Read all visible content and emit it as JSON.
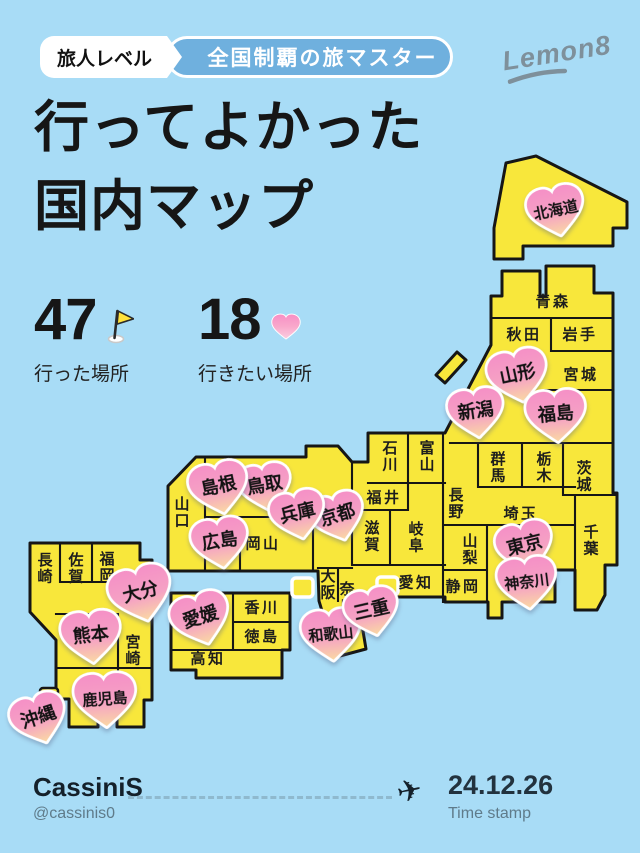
{
  "badge": {
    "level_label": "旅人レベル",
    "level_title": "全国制覇の旅マスター"
  },
  "logo_text": "Lemon8",
  "title": {
    "line1": "行ってよかった",
    "line2": "国内マップ"
  },
  "stats": {
    "visited": {
      "value": "47",
      "label": "行った場所",
      "icon": "flag-icon"
    },
    "wishlist": {
      "value": "18",
      "label": "行きたい場所",
      "icon": "heart-icon"
    }
  },
  "footer": {
    "username": "CassiniS",
    "handle": "@cassinis0",
    "plane_icon": "✈",
    "date": "24.12.26",
    "date_label": "Time stamp"
  },
  "colors": {
    "background": "#A8DCF6",
    "land_yellow": "#F8E73B",
    "outline": "#161616",
    "heart_pink_top": "#F590C6",
    "heart_peach_bottom": "#FAD7A4",
    "badge_blue": "#6FB0DE",
    "logo_gray": "#7E909B",
    "muted_text": "#5F7B8A"
  },
  "map": {
    "labels": [
      {
        "text": "青森",
        "x": 553,
        "y": 301,
        "o": "h"
      },
      {
        "text": "秋田",
        "x": 524,
        "y": 334,
        "o": "h"
      },
      {
        "text": "岩手",
        "x": 580,
        "y": 334,
        "o": "h"
      },
      {
        "text": "宮城",
        "x": 581,
        "y": 374,
        "o": "h"
      },
      {
        "text": "群馬",
        "x": 498,
        "y": 467,
        "o": "v"
      },
      {
        "text": "栃木",
        "x": 544,
        "y": 467,
        "o": "v"
      },
      {
        "text": "茨城",
        "x": 584,
        "y": 476,
        "o": "v"
      },
      {
        "text": "埼玉",
        "x": 521,
        "y": 513,
        "o": "h"
      },
      {
        "text": "千葉",
        "x": 591,
        "y": 540,
        "o": "v"
      },
      {
        "text": "山梨",
        "x": 470,
        "y": 549,
        "o": "v"
      },
      {
        "text": "長野",
        "x": 456,
        "y": 503,
        "o": "v"
      },
      {
        "text": "静岡",
        "x": 463,
        "y": 586,
        "o": "h"
      },
      {
        "text": "石川",
        "x": 390,
        "y": 456,
        "o": "v"
      },
      {
        "text": "富山",
        "x": 427,
        "y": 456,
        "o": "v"
      },
      {
        "text": "福井",
        "x": 384,
        "y": 497,
        "o": "h"
      },
      {
        "text": "滋賀",
        "x": 372,
        "y": 536,
        "o": "v"
      },
      {
        "text": "岐阜",
        "x": 416,
        "y": 537,
        "o": "v"
      },
      {
        "text": "愛知",
        "x": 416,
        "y": 582,
        "o": "h"
      },
      {
        "text": "大阪",
        "x": 328,
        "y": 584,
        "o": "v"
      },
      {
        "text": "奈良",
        "x": 347,
        "y": 597,
        "o": "v"
      },
      {
        "text": "山口",
        "x": 182,
        "y": 512,
        "o": "v"
      },
      {
        "text": "岡山",
        "x": 263,
        "y": 543,
        "o": "h"
      },
      {
        "text": "香川",
        "x": 262,
        "y": 607,
        "o": "h"
      },
      {
        "text": "徳島",
        "x": 262,
        "y": 636,
        "o": "h"
      },
      {
        "text": "高知",
        "x": 208,
        "y": 658,
        "o": "h"
      },
      {
        "text": "長崎",
        "x": 45,
        "y": 568,
        "o": "v"
      },
      {
        "text": "佐賀",
        "x": 76,
        "y": 568,
        "o": "v"
      },
      {
        "text": "福岡",
        "x": 107,
        "y": 567,
        "o": "v"
      },
      {
        "text": "宮崎",
        "x": 133,
        "y": 650,
        "o": "v"
      }
    ],
    "hearts": [
      {
        "label": "北海道",
        "x": 556,
        "y": 211,
        "w": 60,
        "rot": -12
      },
      {
        "label": "山形",
        "x": 518,
        "y": 376,
        "w": 63,
        "rot": -12
      },
      {
        "label": "新潟",
        "x": 476,
        "y": 413,
        "w": 59,
        "rot": -8
      },
      {
        "label": "福島",
        "x": 556,
        "y": 416,
        "w": 63,
        "rot": -5
      },
      {
        "label": "東京",
        "x": 525,
        "y": 547,
        "w": 60,
        "rot": -14
      },
      {
        "label": "神奈川",
        "x": 527,
        "y": 583,
        "w": 62,
        "rot": -7
      },
      {
        "label": "鳥取",
        "x": 265,
        "y": 487,
        "w": 56,
        "rot": -10
      },
      {
        "label": "島根",
        "x": 219,
        "y": 488,
        "w": 62,
        "rot": -12
      },
      {
        "label": "京都",
        "x": 338,
        "y": 517,
        "w": 57,
        "rot": -17
      },
      {
        "label": "兵庫",
        "x": 298,
        "y": 515,
        "w": 58,
        "rot": -13
      },
      {
        "label": "広島",
        "x": 220,
        "y": 543,
        "w": 60,
        "rot": -9
      },
      {
        "label": "大分",
        "x": 141,
        "y": 594,
        "w": 66,
        "rot": -15
      },
      {
        "label": "熊本",
        "x": 91,
        "y": 637,
        "w": 63,
        "rot": -6
      },
      {
        "label": "鹿児島",
        "x": 105,
        "y": 700,
        "w": 65,
        "rot": -4
      },
      {
        "label": "沖縄",
        "x": 39,
        "y": 719,
        "w": 59,
        "rot": -18
      },
      {
        "label": "愛媛",
        "x": 201,
        "y": 619,
        "w": 62,
        "rot": -17
      },
      {
        "label": "和歌山",
        "x": 331,
        "y": 635,
        "w": 62,
        "rot": -6
      },
      {
        "label": "三重",
        "x": 372,
        "y": 612,
        "w": 57,
        "rot": -13
      }
    ]
  }
}
